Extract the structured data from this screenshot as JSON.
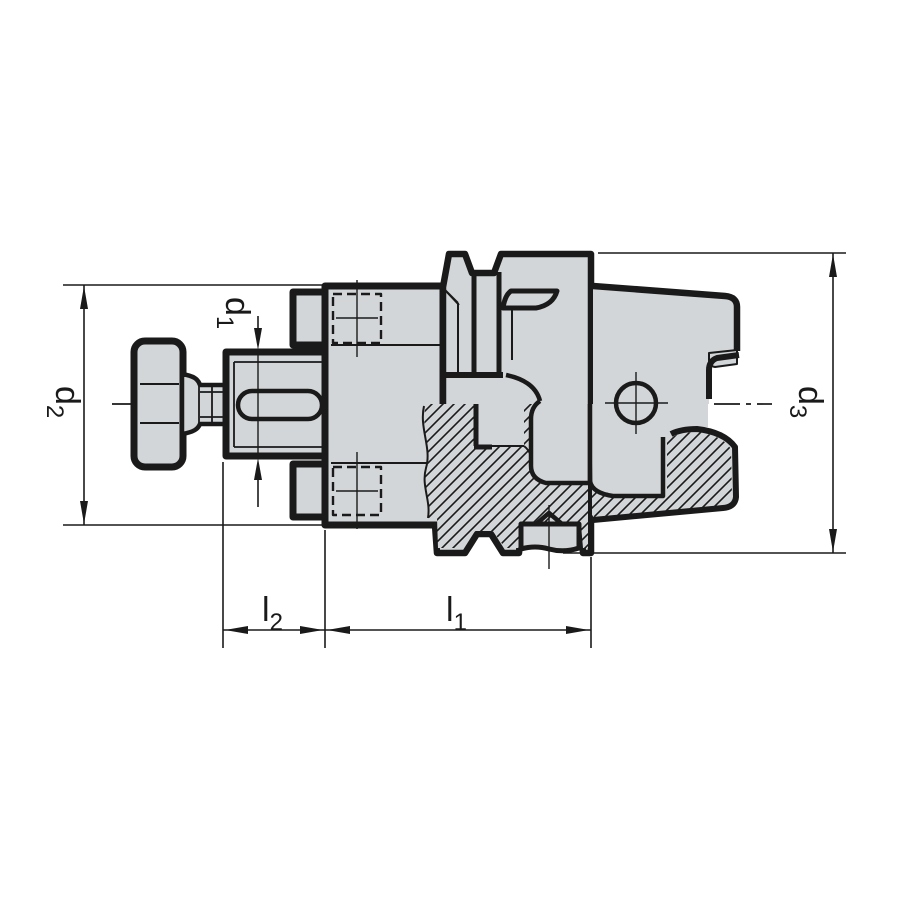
{
  "drawing": {
    "kind": "engineering-section-drawing",
    "background": "#ffffff",
    "body_fill": "#d3d6d8",
    "line_color": "#1a1a1a"
  },
  "dims": {
    "d1": {
      "letter": "d",
      "sub": "1"
    },
    "d2": {
      "letter": "d",
      "sub": "2"
    },
    "d3": {
      "letter": "d",
      "sub": "3"
    },
    "l1": {
      "letter": "l",
      "sub": "1"
    },
    "l2": {
      "letter": "l",
      "sub": "2"
    }
  }
}
